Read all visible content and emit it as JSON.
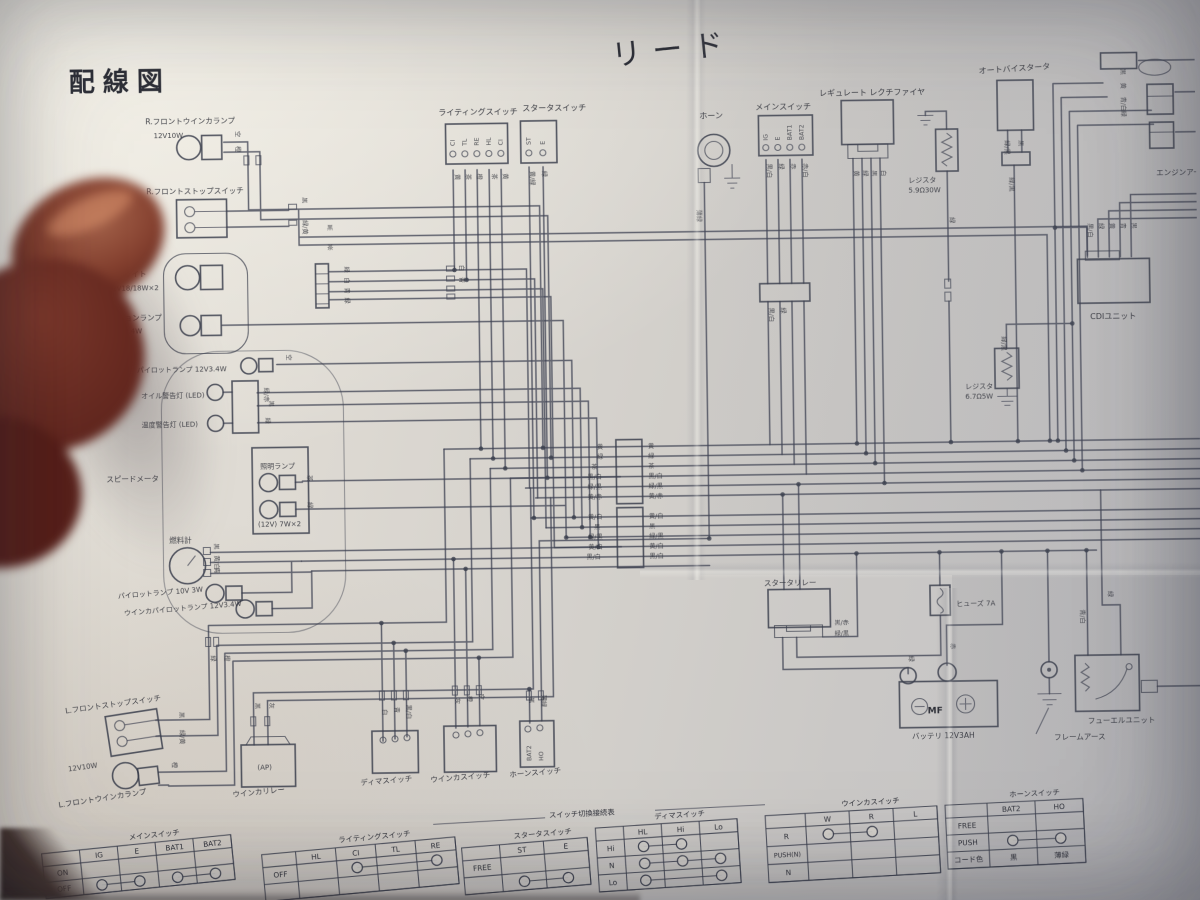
{
  "page": {
    "title": "配線図",
    "model": "リード"
  },
  "colors": {
    "ink": "#3f4354",
    "paper": "#d8d5cf",
    "finger": "#61261e"
  },
  "labels": {
    "r_front_winker": "R.フロントウインカランプ",
    "r_front_winker_spec": "12V10W",
    "r_front_stop": "R.フロントストップスイッチ",
    "headlight": "ヘッドライト",
    "headlight_spec": "12V18/18W×2",
    "position_lamp": "ポジションランプ",
    "position_lamp_spec": "12V3.4W",
    "pilot_lamp": "パイロットランプ 12V3.4W",
    "oil_warning": "オイル警告灯 (LED)",
    "temp_warning": "温度警告灯 (LED)",
    "speedometer": "スピードメータ",
    "illumination_lamp": "照明ランプ",
    "illumination_spec": "(12V) 7W×2",
    "fuel_meter": "燃料計",
    "lamp_a": "パイロットランプ 10V 3W",
    "lamp_b": "ウインカパイロットランプ 12V3.4W",
    "l_front_stop": "L.フロントストップスイッチ",
    "l_front_winker_spec": "12V10W",
    "l_front_winker": "L.フロントウインカランプ",
    "winker_relay": "ウインカリレー",
    "winker_relay_ap": "(AP)",
    "dimmer_switch": "ディマスイッチ",
    "winker_switch": "ウインカスイッチ",
    "horn_switch": "ホーンスイッチ",
    "lighting_switch": "ライティングスイッチ",
    "starter_switch": "スタータスイッチ",
    "horn": "ホーン",
    "main_switch": "メインスイッチ",
    "regulator": "レギュレート レクチファイヤ",
    "resistor1": "レジスタ",
    "resistor1_spec": "5.9Ω30W",
    "auto_bystarter": "オートバイスタータ",
    "cdi": "CDIユニット",
    "resistor2": "レジスタ",
    "resistor2_spec": "6.7Ω5W",
    "engine_earth": "エンジンアース",
    "starter_relay": "スタータリレー",
    "fuse": "ヒューズ 7A",
    "battery": "バッテリ 12V3AH",
    "battery_mf": "MF",
    "battery_minus": "−",
    "battery_plus": "+",
    "frame_earth": "フレームアース",
    "fuel_unit": "フューエルユニット"
  },
  "terminals": {
    "lighting": [
      "CI",
      "TL",
      "RE",
      "HL",
      "CI"
    ],
    "starter": [
      "ST",
      "E"
    ],
    "main": [
      "IG",
      "E",
      "BAT1",
      "BAT2"
    ],
    "horn_switch": [
      "BAT2",
      "HO"
    ]
  },
  "tables_header": "スイッチ切換接続表",
  "tables": [
    {
      "title": "メインスイッチ",
      "x": 36,
      "y": 846,
      "rot": -5,
      "label_w": 38,
      "col_w": 38,
      "row_h": 16,
      "cols": [
        "IG",
        "E",
        "BAT1",
        "BAT2"
      ],
      "rows": [
        {
          "label": "ON",
          "cells": [
            "",
            "",
            "",
            ""
          ]
        },
        {
          "label": "OFF",
          "cells": [
            "○",
            "○",
            "○",
            "○"
          ],
          "links": [
            [
              0,
              1
            ],
            [
              2,
              3
            ]
          ]
        }
      ]
    },
    {
      "title": "ライティングスイッチ",
      "x": 256,
      "y": 850,
      "rot": -4.5,
      "label_w": 34,
      "col_w": 40,
      "row_h": 17,
      "cols": [
        "HL",
        "CI",
        "TL",
        "RE"
      ],
      "rows": [
        {
          "label": "OFF",
          "cells": [
            "",
            "○",
            "",
            "○"
          ],
          "links": [
            [
              1,
              3
            ]
          ]
        },
        {
          "label": "",
          "cells": [
            "",
            "",
            "",
            ""
          ]
        }
      ]
    },
    {
      "title": "スタータスイッチ",
      "x": 456,
      "y": 846,
      "rot": -4,
      "label_w": 38,
      "col_w": 44,
      "row_h": 17,
      "cols": [
        "ST",
        "E"
      ],
      "rows": [
        {
          "label": "FREE",
          "cells": [
            "",
            ""
          ]
        },
        {
          "label": "",
          "cells": [
            "○",
            "○"
          ],
          "links": [
            [
              0,
              1
            ]
          ]
        }
      ]
    },
    {
      "title": "ディマスイッチ",
      "x": 590,
      "y": 828,
      "rot": -3,
      "label_w": 28,
      "col_w": 38,
      "row_h": 17,
      "cols": [
        "HL",
        "Hi",
        "Lo"
      ],
      "rows": [
        {
          "label": "Hi",
          "cells": [
            "○",
            "○",
            ""
          ],
          "links": [
            [
              0,
              1
            ]
          ]
        },
        {
          "label": "N",
          "cells": [
            "○",
            "○",
            "○"
          ],
          "links": [
            [
              0,
              1
            ],
            [
              1,
              2
            ]
          ]
        },
        {
          "label": "Lo",
          "cells": [
            "○",
            "",
            "○"
          ],
          "links": [
            [
              0,
              2
            ]
          ]
        }
      ]
    },
    {
      "title": "ウインカスイッチ",
      "x": 760,
      "y": 818,
      "rot": -2.5,
      "label_w": 40,
      "col_w": 44,
      "row_h": 18,
      "cols": [
        "W",
        "R",
        "L"
      ],
      "rows": [
        {
          "label": "R",
          "cells": [
            "○",
            "○",
            ""
          ],
          "links": [
            [
              0,
              1
            ]
          ]
        },
        {
          "label": "PUSH(N)",
          "cells": [
            "",
            "",
            ""
          ]
        },
        {
          "label": "N",
          "cells": [
            "",
            "",
            ""
          ]
        }
      ]
    },
    {
      "title": "ホーンスイッチ",
      "x": 940,
      "y": 810,
      "rot": -2,
      "label_w": 42,
      "col_w": 48,
      "row_h": 17,
      "cols": [
        "BAT2",
        "HO"
      ],
      "rows": [
        {
          "label": "FREE",
          "cells": [
            "",
            ""
          ]
        },
        {
          "label": "PUSH",
          "cells": [
            "○",
            "○"
          ],
          "links": [
            [
              0,
              1
            ]
          ]
        },
        {
          "label": "コード色",
          "cells": [
            "黒",
            "薄緑"
          ]
        }
      ]
    }
  ],
  "wire_labels": [
    [
      240,
      126,
      "空"
    ],
    [
      240,
      141,
      "橙"
    ],
    [
      306,
      193,
      "黒"
    ],
    [
      306,
      216,
      "緑/黄"
    ],
    [
      347,
      263,
      "緑"
    ],
    [
      347,
      274,
      "白"
    ],
    [
      347,
      284,
      "青"
    ],
    [
      347,
      294,
      "緑"
    ],
    [
      462,
      263,
      "白"
    ],
    [
      462,
      275,
      "青"
    ],
    [
      330,
      226,
      "黒",
      0
    ],
    [
      330,
      246,
      "茶",
      0
    ],
    [
      288,
      350,
      "空"
    ],
    [
      265,
      383,
      "緑/赤"
    ],
    [
      270,
      396,
      "黒"
    ],
    [
      266,
      413,
      "緑"
    ],
    [
      307,
      471,
      "茶"
    ],
    [
      307,
      498,
      "緑"
    ],
    [
      213,
      538,
      "黒"
    ],
    [
      213,
      550,
      "黄/白"
    ],
    [
      213,
      562,
      "青"
    ],
    [
      459,
      172,
      "黄"
    ],
    [
      470,
      172,
      "茶"
    ],
    [
      481,
      172,
      "橙"
    ],
    [
      496,
      172,
      "茶"
    ],
    [
      507,
      172,
      "黄"
    ],
    [
      534,
      170,
      "黄/緑"
    ],
    [
      546,
      170,
      "緑"
    ],
    [
      700,
      211,
      "薄緑"
    ],
    [
      771,
      166,
      "黒/白"
    ],
    [
      783,
      166,
      "緑"
    ],
    [
      795,
      166,
      "赤"
    ],
    [
      807,
      166,
      "赤/白"
    ],
    [
      771,
      310,
      "黒/白"
    ],
    [
      783,
      310,
      "緑"
    ],
    [
      858,
      174,
      "黄"
    ],
    [
      867,
      174,
      "緑"
    ],
    [
      876,
      174,
      "黒"
    ],
    [
      885,
      174,
      "白"
    ],
    [
      953,
      222,
      "緑"
    ],
    [
      1009,
      146,
      "緑/黒"
    ],
    [
      1023,
      146,
      "黒"
    ],
    [
      1013,
      183,
      "緑/黒"
    ],
    [
      1091,
      230,
      "黒/白"
    ],
    [
      1102,
      230,
      "緑"
    ],
    [
      1113,
      230,
      "黄"
    ],
    [
      1124,
      230,
      "青"
    ],
    [
      1135,
      230,
      "黒"
    ],
    [
      1003,
      342,
      "緑/黒"
    ],
    [
      1126,
      76,
      "黒"
    ],
    [
      1126,
      90,
      "黄"
    ],
    [
      1126,
      104,
      "青/白"
    ],
    [
      1126,
      118,
      "緑"
    ],
    [
      597,
      449,
      "黄",
      0
    ],
    [
      597,
      459,
      "緑",
      0
    ],
    [
      591,
      469,
      "茶",
      0
    ],
    [
      587,
      479,
      "黒/白",
      0
    ],
    [
      587,
      489,
      "緑/黒",
      0
    ],
    [
      587,
      499,
      "黄/赤",
      0
    ],
    [
      587,
      519,
      "黄/白",
      0
    ],
    [
      593,
      529,
      "黒",
      0
    ],
    [
      587,
      539,
      "緑/黒",
      0
    ],
    [
      587,
      549,
      "黄/白",
      0
    ],
    [
      585,
      559,
      "黒/白",
      0
    ],
    [
      648,
      449,
      "黄",
      0
    ],
    [
      648,
      459,
      "緑",
      0
    ],
    [
      648,
      469,
      "茶",
      0
    ],
    [
      648,
      479,
      "黒/白",
      0
    ],
    [
      648,
      489,
      "緑/黒",
      0
    ],
    [
      648,
      499,
      "黄/赤",
      0
    ],
    [
      648,
      519,
      "黄/白",
      0
    ],
    [
      648,
      529,
      "黒",
      0
    ],
    [
      648,
      539,
      "緑/黒",
      0
    ],
    [
      648,
      549,
      "黄/白",
      0
    ],
    [
      648,
      559,
      "黒/白",
      0
    ],
    [
      208,
      650,
      "緑"
    ],
    [
      222,
      650,
      "橙"
    ],
    [
      252,
      698,
      "黒"
    ],
    [
      266,
      698,
      "灰"
    ],
    [
      379,
      706,
      "白"
    ],
    [
      391,
      704,
      "青"
    ],
    [
      403,
      702,
      "黒/白"
    ],
    [
      452,
      696,
      "灰"
    ],
    [
      464,
      694,
      "橙"
    ],
    [
      476,
      692,
      "空"
    ],
    [
      526,
      696,
      "黒"
    ],
    [
      538,
      694,
      "薄緑"
    ],
    [
      832,
      628,
      "黒/赤",
      0
    ],
    [
      832,
      639,
      "緑/黒",
      0
    ],
    [
      906,
      660,
      "緑"
    ],
    [
      948,
      648,
      "赤"
    ],
    [
      1078,
      616,
      "青/白"
    ],
    [
      1106,
      598,
      "緑"
    ],
    [
      176,
      706,
      "黒"
    ],
    [
      176,
      724,
      "緑/黄"
    ],
    [
      168,
      756,
      "橙"
    ]
  ]
}
